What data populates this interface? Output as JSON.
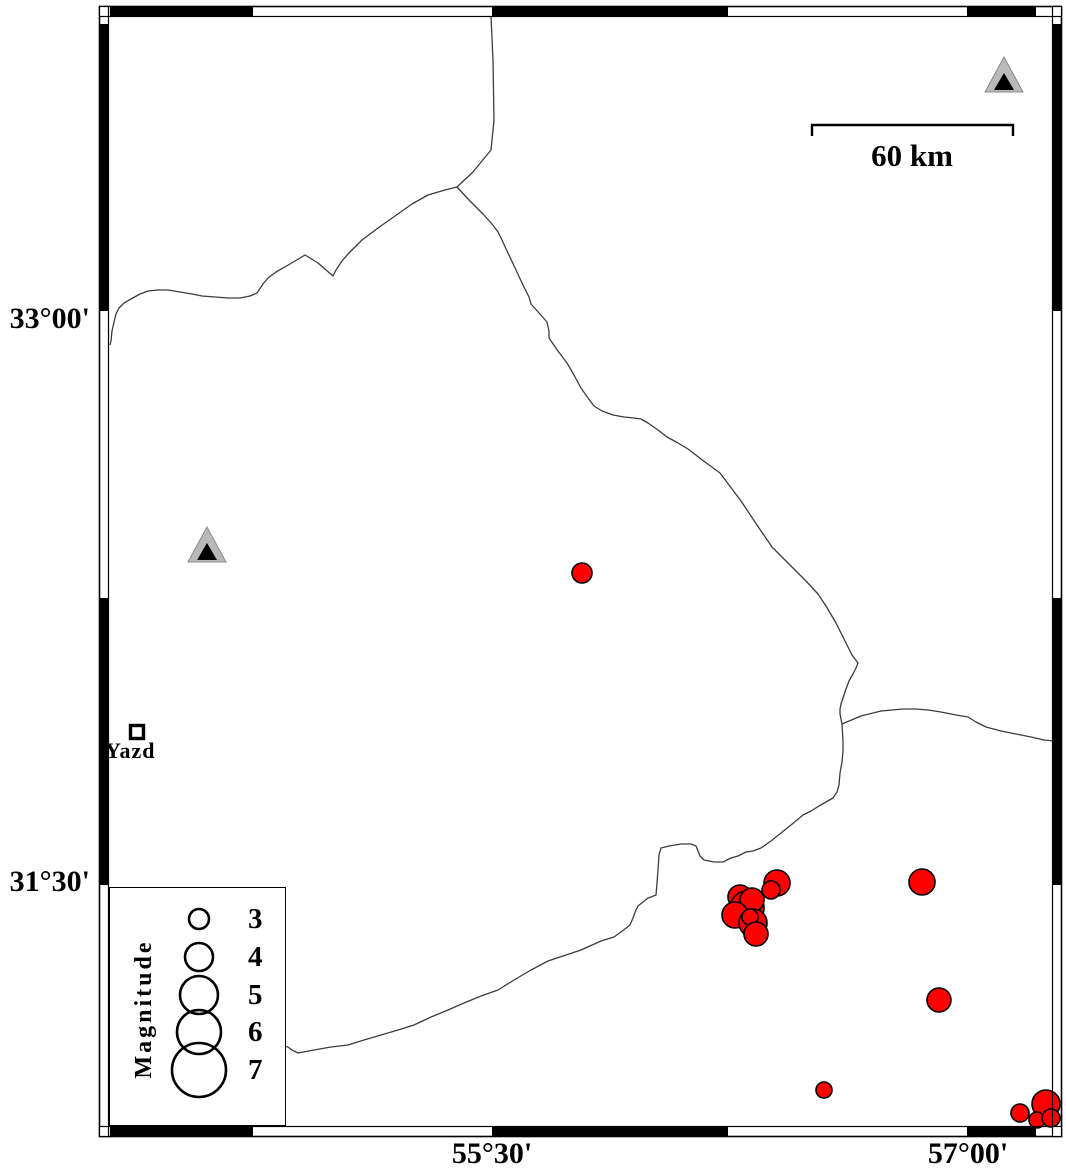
{
  "labels": {
    "lat_top": "33°00'",
    "lat_bottom": "31°30'",
    "lon_left": "55°30'",
    "lon_right": "57°00'",
    "scale": "60 km",
    "city": "Yazd"
  },
  "legend": {
    "title": "Magnitude",
    "entries": [
      {
        "magnitude": "3",
        "radius": 10
      },
      {
        "magnitude": "4",
        "radius": 14
      },
      {
        "magnitude": "5",
        "radius": 19
      },
      {
        "magnitude": "6",
        "radius": 22
      },
      {
        "magnitude": "7",
        "radius": 27
      }
    ]
  },
  "colors": {
    "earthquake": "#ff0000",
    "station_fill": "#b9b9b9",
    "station_inner": "#000000",
    "boundary": "#3c3c3c"
  },
  "map_data": {
    "type": "map",
    "earthquakes": [
      {
        "x": 582,
        "y": 573,
        "r": 10
      },
      {
        "x": 777,
        "y": 883,
        "r": 13
      },
      {
        "x": 771,
        "y": 890,
        "r": 9
      },
      {
        "x": 740,
        "y": 897,
        "r": 12
      },
      {
        "x": 747,
        "y": 908,
        "r": 17
      },
      {
        "x": 752,
        "y": 900,
        "r": 12
      },
      {
        "x": 735,
        "y": 915,
        "r": 13
      },
      {
        "x": 753,
        "y": 923,
        "r": 14
      },
      {
        "x": 750,
        "y": 917,
        "r": 8
      },
      {
        "x": 756,
        "y": 934,
        "r": 12
      },
      {
        "x": 922,
        "y": 882,
        "r": 13
      },
      {
        "x": 939,
        "y": 1000,
        "r": 12
      },
      {
        "x": 824,
        "y": 1090,
        "r": 8
      },
      {
        "x": 1020,
        "y": 1113,
        "r": 9
      },
      {
        "x": 1046,
        "y": 1104,
        "r": 14
      },
      {
        "x": 1037,
        "y": 1120,
        "r": 8
      },
      {
        "x": 1051,
        "y": 1118,
        "r": 9
      }
    ],
    "stations": [
      {
        "x": 207,
        "y": 545
      },
      {
        "x": 1004,
        "y": 75
      }
    ],
    "city_marker": {
      "x": 137,
      "y": 732
    },
    "boundary_lines": [
      {
        "points": "491,16 493,60 494,120 491,150 473,172 457,187"
      },
      {
        "points": "457,187 445,190 428,195 412,204 395,216 378,228 362,240 348,254 342,261 336,270 333,276 318,263 305,255 290,264 276,272 268,278 263,284 259,290 257,293 250,296 240,298 228,298 215,297 202,296 192,294 180,292 168,290 158,290 148,291 140,294 131,299 124,303 119,308 116,314 114,322 112,331 111,341 110,345"
      },
      {
        "points": "457,187 470,201 483,214 492,224 498,232 501,238 508,253 516,270 523,285 529,297 531,304 539,313 547,322 549,331 549,338 558,351 567,363 574,375 581,388 588,398 594,406 602,411 613,415 624,417 634,418 641,419 648,423 658,430 667,437 678,443 688,449 701,459 720,473 741,501 757,525 772,547 791,566 806,581 818,594 826,606 836,623 844,639 852,655 858,663 856,668 853,674 849,681 846,689 843,698 841,704 840,709 840,714 841,719 842,724"
      },
      {
        "points": "842,724 861,716 881,711 903,709 916,709 928,710 941,712 956,715 968,717 976,722 986,727 1001,731 1016,734 1031,737 1044,740 1054,741"
      },
      {
        "points": "842,724 843,741 843,751 842,762 840,773 839,785 837,792 835,795 833,798 826,802 819,806 811,811 803,815 791,825 781,833 771,841 761,848 753,851 746,852 738,856 731,858 723,862 714,862 709,861 704,860 700,856 698,851 696,846 691,844 681,844 669,846 661,848 659,855 658,870 657,883 656,895 651,897 648,898 643,902 638,906 636,910 633,918 630,925 621,932 614,937 601,941 581,950 566,955 548,961 531,970 514,980 498,990 481,996 464,1003 448,1010 431,1017 414,1025 398,1030 381,1035 364,1040 348,1045 331,1047 314,1050 298,1053 292,1050 288,1047 284,1046"
      }
    ],
    "frame": {
      "outer": [
        99.5,
        6.5,
        962,
        1130
      ],
      "inner": [
        108.5,
        16.5,
        944,
        1110
      ],
      "top_bottom_black": [
        [
          110,
          253
        ],
        [
          492,
          728
        ],
        [
          967,
          1036
        ]
      ],
      "left_right_black": [
        [
          24,
          311
        ],
        [
          598,
          885
        ]
      ]
    },
    "scale_bar": {
      "x1": 812,
      "x2": 1013,
      "y": 125,
      "tick_drop": 11
    }
  }
}
